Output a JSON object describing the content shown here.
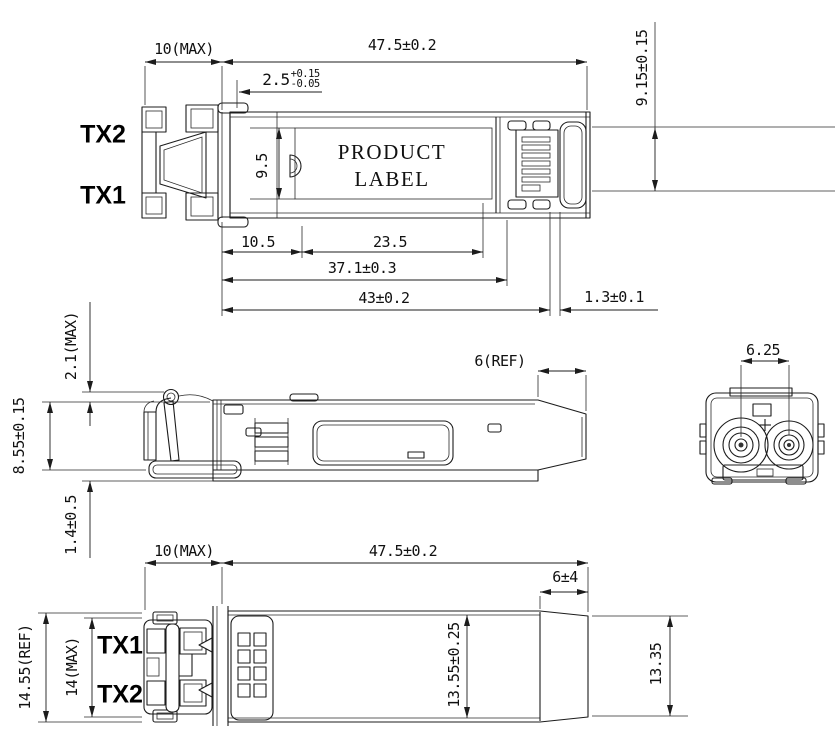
{
  "product_label": {
    "line1": "PRODUCT",
    "line2": "LABEL"
  },
  "top_view": {
    "port_top": "TX2",
    "port_bottom": "TX1",
    "dims": {
      "front_length": "10(MAX)",
      "overall_length": "47.5±0.2",
      "tab_offset": {
        "value": "2.5",
        "tol_upper": "+0.15",
        "tol_lower": "-0.05"
      },
      "label_width": "9.5",
      "rear_width": "9.15±0.15",
      "front_to_label": "10.5",
      "label_length": "23.5",
      "to_rear_stop": "37.1±0.3",
      "body_length": "43±0.2",
      "rear_gap": "1.3±0.1"
    }
  },
  "side_view": {
    "dims": {
      "latch_protrusion": "2.1(MAX)",
      "body_height": "8.55±0.15",
      "bottom_protrusion": "1.4±0.5",
      "rear_taper": "6(REF)"
    }
  },
  "end_view": {
    "dims": {
      "port_pitch": "6.25"
    }
  },
  "bottom_view": {
    "port_top": "TX1",
    "port_bottom": "TX2",
    "dims": {
      "front_length": "10(MAX)",
      "overall_length": "47.5±0.2",
      "rear_taper": "6±4",
      "overall_width": "14.55(REF)",
      "body_width_max": "14(MAX)",
      "mid_width": "13.55±0.25",
      "rear_width": "13.35"
    }
  },
  "colors": {
    "line": "#1c1c1c",
    "background": "#ffffff"
  }
}
